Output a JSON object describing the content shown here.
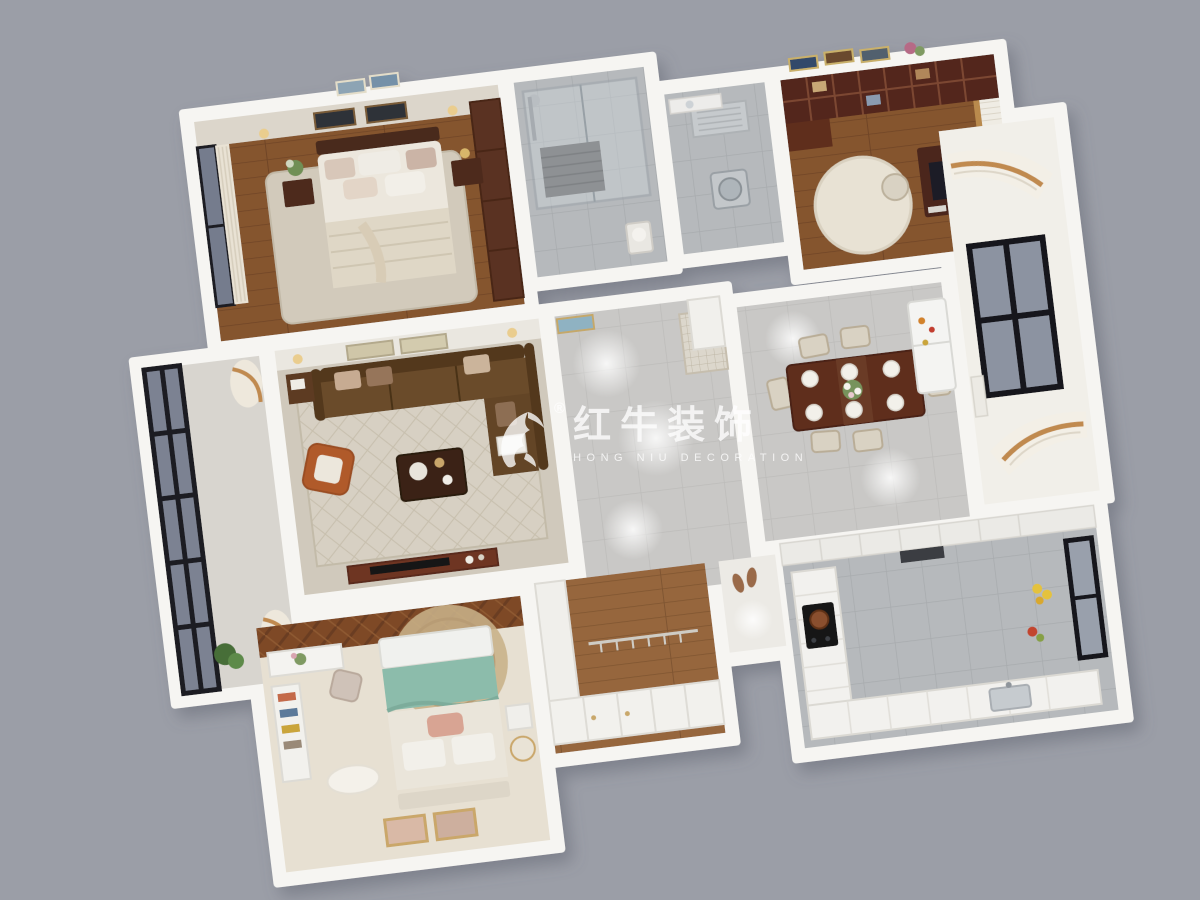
{
  "watermark": {
    "brand_cn": "红牛装饰",
    "brand_en": "HONG NIU DECORATION",
    "registered": "®",
    "logo_icon": "bull-icon",
    "color": "#ffffff"
  },
  "palette": {
    "background": "#9b9ea7",
    "wall_white": "#f6f5f2",
    "wood_floor": "#85552f",
    "tile_gray": "#b6b9bc",
    "hall_tile": "#c9c8c6",
    "sofa_brown": "#6b4b2a",
    "accent_orange": "#b05a2c",
    "teal_blanket": "#8cbcab",
    "dark_wood": "#5a3020",
    "dining_table": "#5f2e1d"
  },
  "rooms": [
    {
      "id": "master-bedroom"
    },
    {
      "id": "shower-bathroom"
    },
    {
      "id": "second-bathroom"
    },
    {
      "id": "study"
    },
    {
      "id": "balcony"
    },
    {
      "id": "living-room"
    },
    {
      "id": "hallway"
    },
    {
      "id": "dining-room"
    },
    {
      "id": "window-bay"
    },
    {
      "id": "second-bedroom"
    },
    {
      "id": "walk-in-closet"
    },
    {
      "id": "kitchen"
    },
    {
      "id": "rear-corridor"
    }
  ]
}
